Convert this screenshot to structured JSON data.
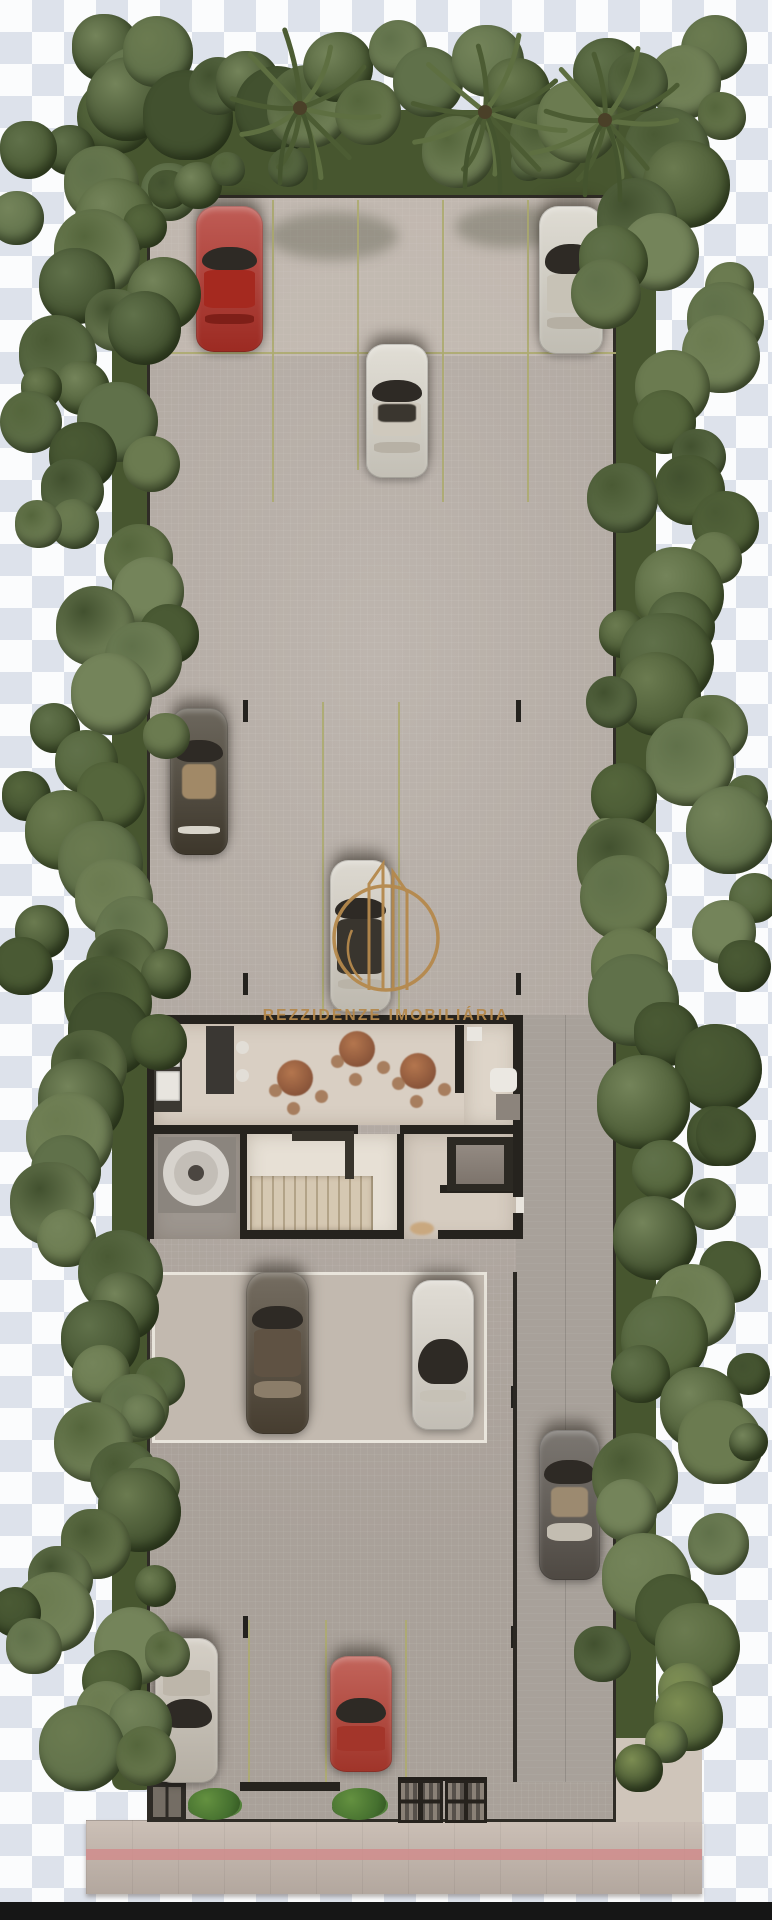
{
  "watermark": {
    "text": "REZZIDENZE IMOBILIÁRIA",
    "emblem": "twin-tower-monogram-in-circle",
    "color": "#b5894c"
  },
  "scene": {
    "type": "architectural-site-plan-top-view",
    "background": {
      "checker_light": "#fbfcfd",
      "checker_dark": "#dde2eb",
      "bottom_bar": "#161616"
    },
    "palette": {
      "pavement": "#b6ada5",
      "pavement_light": "#c9c0b5",
      "stall_line": "#adab70",
      "wall": "#26231e",
      "hedge": "#47562f",
      "tree_greens": [
        "#55663c",
        "#60714a",
        "#4a5a34",
        "#6b7b50",
        "#42512f",
        "#74845a"
      ],
      "bush_light": "#7c8d52",
      "sidewalk": "#c7bab0",
      "sidewalk_stripe": "#d08c8c",
      "canopy_line": "#e9e5dc",
      "dining_floor": "#d9cfc3",
      "stair_hall_floor": "#e7e0d5",
      "wood_stairs": "#d5c8b2"
    },
    "counts": {
      "cars": 10,
      "dining_tables": 3,
      "grills": 2,
      "bushes": 2
    },
    "cars": [
      {
        "name": "car-red-suv-top-left",
        "color": "#ae2f26",
        "rect": [
          196,
          206,
          67,
          146
        ],
        "glass": [
          28,
          16
        ],
        "roof": [
          44,
          26,
          "#a5291f"
        ],
        "stripe": [
          74,
          7,
          "#7e1f18"
        ]
      },
      {
        "name": "car-white-sedan-top",
        "color": "#d9d5ca",
        "rect": [
          366,
          344,
          62,
          134
        ],
        "glass": [
          27,
          16
        ],
        "roof": [
          43,
          26,
          "#cfc9bd"
        ],
        "patch": [
          45,
          13,
          "#3a362f"
        ],
        "stripe": [
          73,
          8,
          "#b7b1a5"
        ]
      },
      {
        "name": "car-white-suv-top-right",
        "color": "#d6d2c7",
        "rect": [
          539,
          206,
          64,
          148
        ],
        "glass": [
          26,
          20
        ],
        "roof": [
          46,
          26,
          "#c7c2b6"
        ],
        "stripe": [
          75,
          8,
          "#b5afa3"
        ]
      },
      {
        "name": "car-dark-olive-left",
        "color": "#443d30",
        "rect": [
          170,
          708,
          58,
          147
        ],
        "glass": [
          22,
          15
        ],
        "patch": [
          38,
          24,
          "#a18967"
        ],
        "stripe": [
          80,
          6,
          "#d8d4ca"
        ]
      },
      {
        "name": "car-white-center",
        "color": "#d3cec3",
        "rect": [
          330,
          860,
          61,
          152
        ],
        "glass": [
          25,
          14
        ],
        "roof": [
          39,
          36,
          "#39352e"
        ],
        "stripe": [
          78,
          7,
          "#b9b3a7"
        ]
      },
      {
        "name": "car-brown-covered",
        "color": "#4e4435",
        "rect": [
          246,
          1272,
          63,
          162
        ],
        "glass": [
          21,
          14
        ],
        "roof": [
          35,
          30,
          "#5f5243"
        ],
        "stripe": [
          67,
          11,
          "#8b7d69"
        ]
      },
      {
        "name": "car-white-suv-covered",
        "color": "#d8d3c9",
        "rect": [
          412,
          1280,
          62,
          150
        ],
        "glass": [
          39,
          30
        ],
        "stripe": [
          73,
          8,
          "#c6c1b6"
        ]
      },
      {
        "name": "car-gray-right",
        "color": "#57514a",
        "rect": [
          539,
          1430,
          61,
          150
        ],
        "glass": [
          20,
          16
        ],
        "patch": [
          38,
          20,
          "#9c8a70"
        ],
        "stripe": [
          62,
          12,
          "#c3bdb1"
        ]
      },
      {
        "name": "car-beige-bottom-left",
        "color": "#c9c2b6",
        "rect": [
          155,
          1638,
          63,
          145
        ],
        "glass": [
          42,
          20
        ],
        "roof": [
          22,
          18,
          "#bdb6aa"
        ]
      },
      {
        "name": "car-red-bottom",
        "color": "#b23a2e",
        "rect": [
          330,
          1656,
          62,
          116
        ],
        "glass": [
          36,
          22
        ],
        "roof": [
          60,
          22,
          "#a3352a"
        ]
      }
    ],
    "rooms": [
      {
        "name": "kitchen-dining-lounge"
      },
      {
        "name": "pantry-room"
      },
      {
        "name": "stair-hall"
      },
      {
        "name": "elevator-corridor"
      },
      {
        "name": "open-patio-with-rug"
      }
    ]
  }
}
